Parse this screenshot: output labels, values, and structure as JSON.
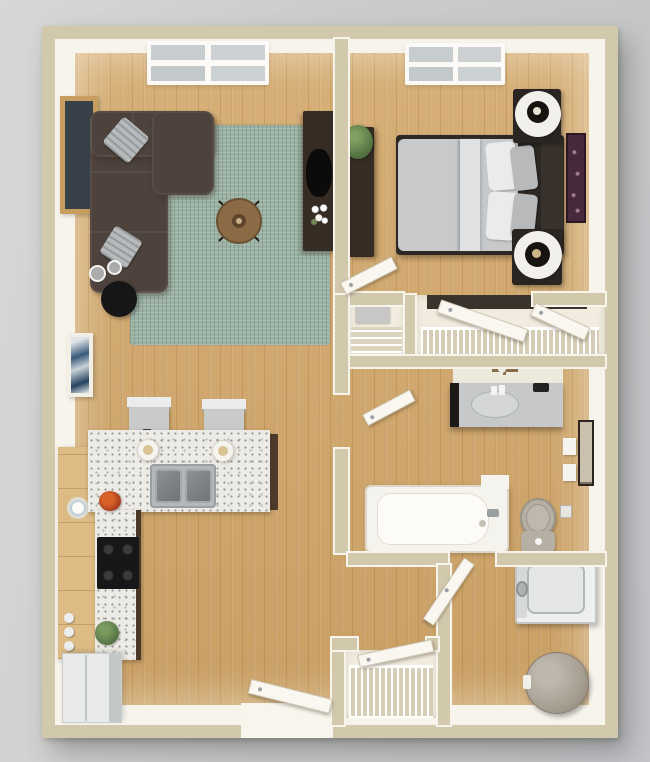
{
  "scene": {
    "title": "One-bedroom apartment 3D floor plan",
    "view": "top-down 3D render, no visible text labels",
    "rooms": {
      "living": {
        "name": "Living Room",
        "items": [
          "sectional-sofa",
          "throw-pillows",
          "area-rug",
          "coffee-table",
          "tv-console",
          "tv",
          "flowers",
          "side-table",
          "glasses",
          "wall-art",
          "window"
        ]
      },
      "kitchen": {
        "name": "Kitchen",
        "items": [
          "island-counter",
          "double-sink",
          "pendant-lights",
          "bar-stools",
          "cooktop",
          "counter",
          "pantry-cabinet",
          "refrigerator",
          "potted-plants",
          "wall-clock"
        ]
      },
      "bedroom": {
        "name": "Bedroom",
        "items": [
          "bed",
          "sheet-fold",
          "pillows",
          "headboard",
          "nightstands",
          "lamps",
          "dresser",
          "potted-plant",
          "wall-art",
          "window",
          "door"
        ]
      },
      "closet": {
        "name": "Bedroom Closet",
        "items": [
          "wire-shelving",
          "bifold-doors",
          "storage-box"
        ]
      },
      "bathroom": {
        "name": "Bathroom",
        "items": [
          "vanity",
          "faucet",
          "sink",
          "bathtub",
          "toilet",
          "towel-hooks",
          "paper-holder",
          "wall-art",
          "door"
        ]
      },
      "laundry": {
        "name": "Laundry / Utility",
        "items": [
          "washer",
          "laundry-basket",
          "door"
        ]
      },
      "entry": {
        "name": "Entry",
        "items": [
          "entry-door",
          "coat-closet",
          "wire-shelving",
          "closet-door"
        ]
      }
    }
  },
  "colors": {
    "background": "#c9cacb",
    "wall": "#d2c9ad",
    "wall_trim": "#f7f4ec",
    "floor_wood": "#cfa76d",
    "rug": "#9bb1a3",
    "sofa": "#4d423c",
    "pillow": "#b7babb",
    "bed_mattress": "#c7c9cb",
    "bed_frame": "#2d2824",
    "wood_furniture": "#8b6b46",
    "dark_furniture": "#362c24",
    "granite": "#edebe6",
    "cabinet_wood": "#dcbc84",
    "tub_white": "#f5f3ee",
    "vanity_top": "#c6c8c9",
    "toilet": "#b5afa4",
    "washer": "#eef0ef",
    "basket": "#a79f92",
    "door": "#faf7f0",
    "plant": "#5d7c4a",
    "art_purple": "#46293c",
    "art_gold": "#c79e5e"
  }
}
